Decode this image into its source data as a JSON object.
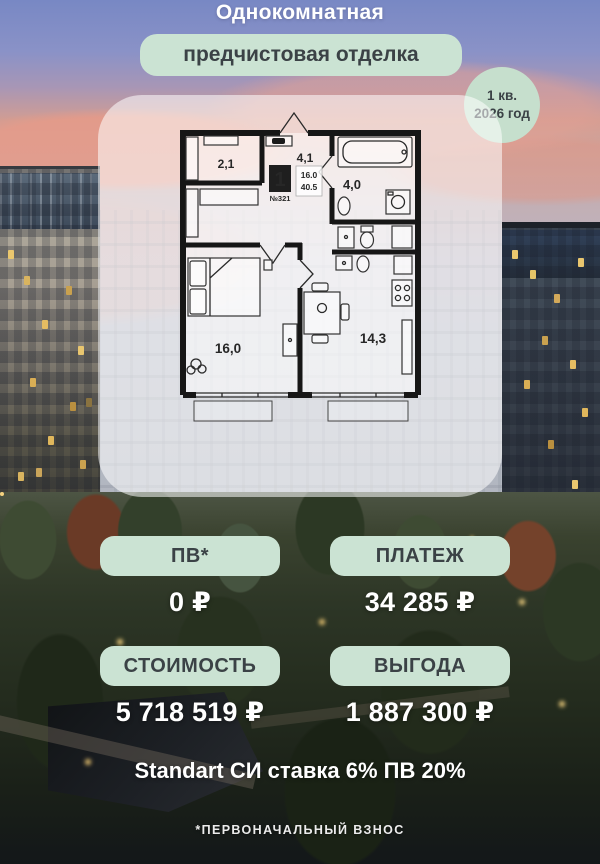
{
  "header": {
    "title": "Однокомнатная",
    "finish_badge": "предчистовая отделка",
    "delivery_badge_line1": "1 кв.",
    "delivery_badge_line2": "2026 год"
  },
  "floorplan": {
    "rooms_count": "1",
    "apartment_number": "№321",
    "living_area": "16.0",
    "total_area": "40.5",
    "labels": {
      "hallway": "2,1",
      "hall": "4,1",
      "bathroom": "4,0",
      "bedroom": "16,0",
      "kitchen": "14,3"
    }
  },
  "offers": [
    {
      "label": "ПВ*",
      "value": "0 ₽"
    },
    {
      "label": "ПЛАТЕЖ",
      "value": "34 285 ₽"
    },
    {
      "label": "СТОИМОСТЬ",
      "value": "5 718 519 ₽"
    },
    {
      "label": "ВЫГОДА",
      "value": "1 887 300 ₽"
    }
  ],
  "footer": {
    "program": "Standart СИ ставка 6% ПВ 20%",
    "footnote": "*ПЕРВОНАЧАЛЬНЫЙ ВЗНОС"
  },
  "colors": {
    "badge_green": "#cbe3d3",
    "text_dark": "#3b4246",
    "text_white": "#ffffff"
  }
}
